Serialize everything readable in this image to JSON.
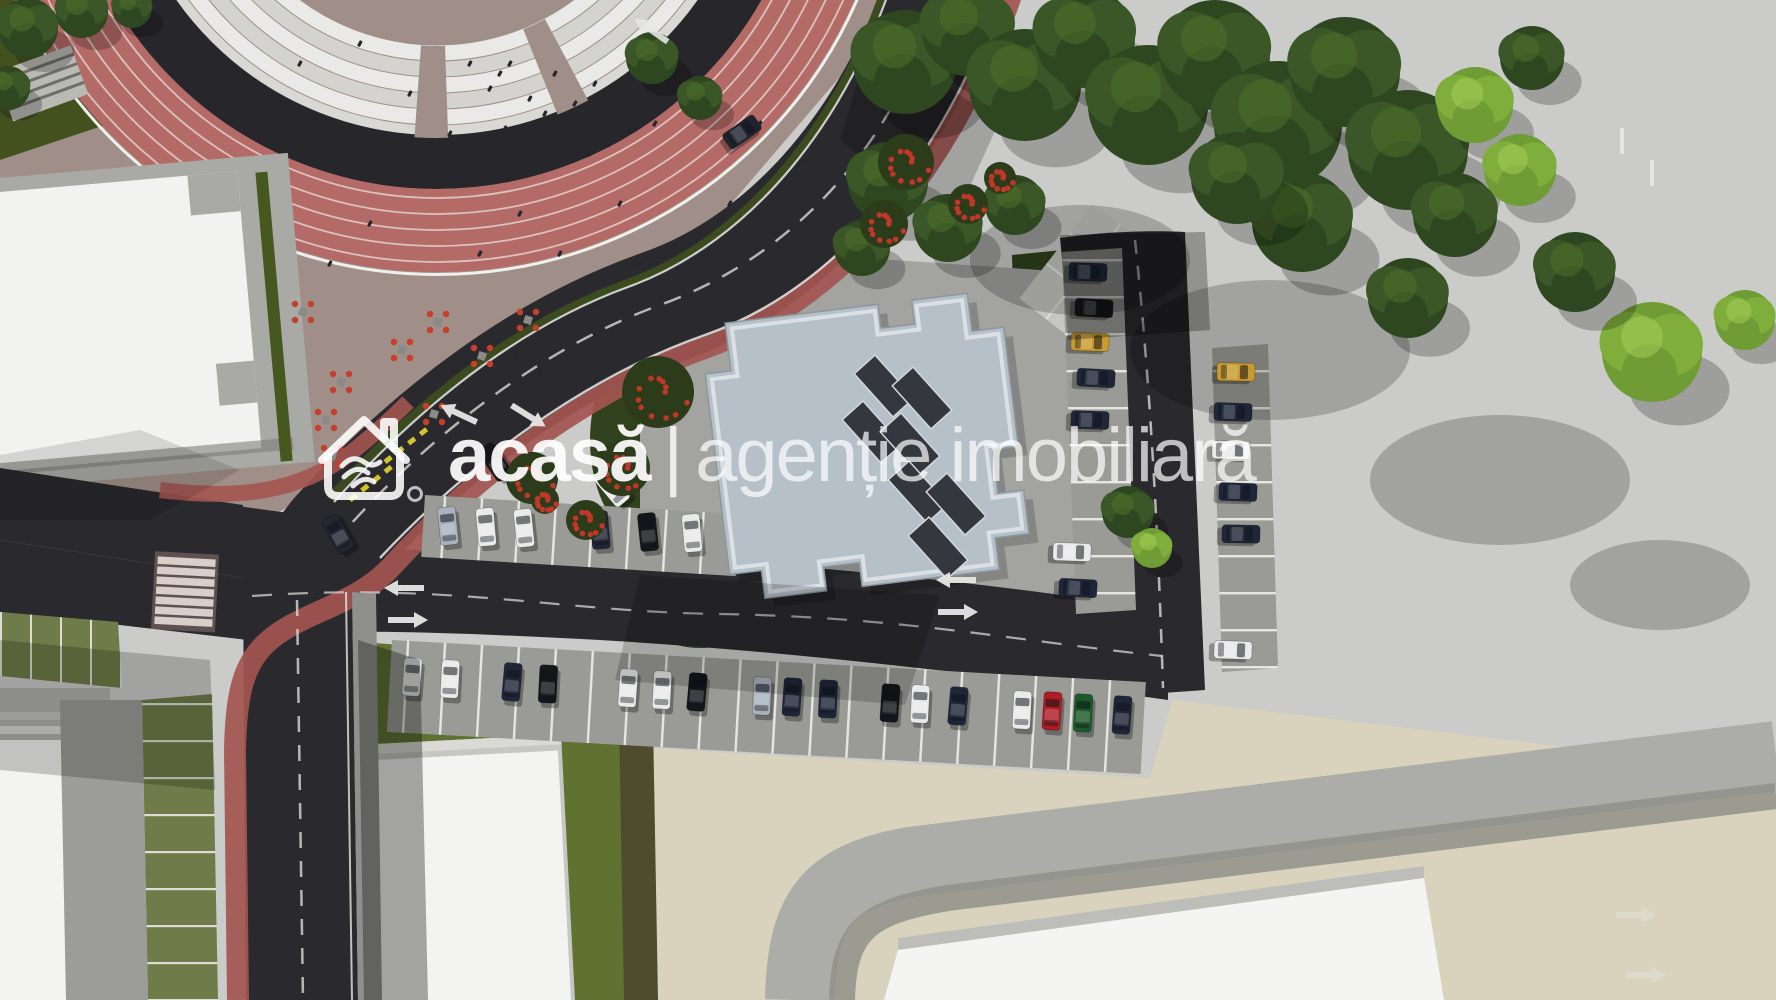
{
  "watermark": {
    "brand": "acasă",
    "separator": "|",
    "tagline": "agenție imobiliară",
    "logo_icon": "house-handshake-icon",
    "color": "#ffffff"
  },
  "scene": {
    "description": "Aerial 3D site plan render: stadium running track top-left, curved boulevard with red bike lanes, central flat-roof building with rooftop panels, parking rows with cars, lawns, trees and concrete esplanade",
    "palette": {
      "asphalt": "#2a2a2e",
      "track_red": "#b46b67",
      "bike_lane_red": "#a35551",
      "plaza_tan": "#a08f88",
      "plaza_beige": "#d9d3bd",
      "concrete": "#cbcbca",
      "roof_blue_gray": "#b6c0c9",
      "lawn_dark": "#31401d",
      "lawn_olive": "#5f7231",
      "paver_green": "#6f7c49",
      "building_white": "#f2f2f0",
      "marking_white": "#e6e6e4",
      "giveway_yellow": "#d4c22e"
    },
    "cars": [
      {
        "x": 412,
        "y": 677,
        "a": 4,
        "c": "#e9eaea"
      },
      {
        "x": 450,
        "y": 679,
        "a": 3,
        "c": "#e9eaea"
      },
      {
        "x": 512,
        "y": 682,
        "a": 5,
        "c": "#1f2638"
      },
      {
        "x": 548,
        "y": 684,
        "a": 3,
        "c": "#15161a"
      },
      {
        "x": 628,
        "y": 688,
        "a": 4,
        "c": "#e9eaea"
      },
      {
        "x": 662,
        "y": 690,
        "a": 3,
        "c": "#e9eaea"
      },
      {
        "x": 697,
        "y": 692,
        "a": 5,
        "c": "#15161a"
      },
      {
        "x": 762,
        "y": 696,
        "a": 3,
        "c": "#aab2bd"
      },
      {
        "x": 792,
        "y": 697,
        "a": 4,
        "c": "#1f2638"
      },
      {
        "x": 828,
        "y": 699,
        "a": 3,
        "c": "#1f2638"
      },
      {
        "x": 890,
        "y": 703,
        "a": 4,
        "c": "#15161a"
      },
      {
        "x": 920,
        "y": 704,
        "a": 3,
        "c": "#e9eaea"
      },
      {
        "x": 958,
        "y": 706,
        "a": 5,
        "c": "#1f2638"
      },
      {
        "x": 1022,
        "y": 710,
        "a": 3,
        "c": "#e9eaea"
      },
      {
        "x": 1052,
        "y": 711,
        "a": 4,
        "c": "#b01c26"
      },
      {
        "x": 1083,
        "y": 713,
        "a": 3,
        "c": "#1c5a2a"
      },
      {
        "x": 1122,
        "y": 715,
        "a": 4,
        "c": "#1f2638"
      },
      {
        "x": 448,
        "y": 526,
        "a": -6,
        "c": "#aab2bd"
      },
      {
        "x": 486,
        "y": 527,
        "a": -5,
        "c": "#e9eaea"
      },
      {
        "x": 524,
        "y": 528,
        "a": -6,
        "c": "#e9eaea"
      },
      {
        "x": 600,
        "y": 530,
        "a": -5,
        "c": "#1f2638"
      },
      {
        "x": 648,
        "y": 532,
        "a": -6,
        "c": "#15161a"
      },
      {
        "x": 692,
        "y": 533,
        "a": -5,
        "c": "#e9eaea"
      },
      {
        "x": 1088,
        "y": 272,
        "a": 92,
        "c": "#1f2638"
      },
      {
        "x": 1094,
        "y": 308,
        "a": 93,
        "c": "#15161a"
      },
      {
        "x": 1090,
        "y": 342,
        "a": 92,
        "c": "#c89b2e"
      },
      {
        "x": 1096,
        "y": 378,
        "a": 93,
        "c": "#1f2638"
      },
      {
        "x": 1090,
        "y": 420,
        "a": 92,
        "c": "#1f2638"
      },
      {
        "x": 1072,
        "y": 552,
        "a": 92,
        "c": "#e9eaea"
      },
      {
        "x": 1078,
        "y": 588,
        "a": 93,
        "c": "#1f2638"
      },
      {
        "x": 1236,
        "y": 372,
        "a": 91,
        "c": "#c89b2e"
      },
      {
        "x": 1233,
        "y": 412,
        "a": 92,
        "c": "#1f2638"
      },
      {
        "x": 1231,
        "y": 450,
        "a": 91,
        "c": "#e9eaea"
      },
      {
        "x": 1238,
        "y": 492,
        "a": 92,
        "c": "#1f2638"
      },
      {
        "x": 1241,
        "y": 534,
        "a": 91,
        "c": "#1f2638"
      },
      {
        "x": 1233,
        "y": 650,
        "a": 92,
        "c": "#e9eaea"
      },
      {
        "x": 338,
        "y": 534,
        "a": -30,
        "c": "#232733"
      },
      {
        "x": 612,
        "y": 488,
        "a": -40,
        "c": "#ededee"
      },
      {
        "x": 495,
        "y": 462,
        "a": -35,
        "c": "#15161a"
      },
      {
        "x": 742,
        "y": 132,
        "a": 55,
        "c": "#20242e"
      }
    ],
    "trees": [
      {
        "x": 905,
        "y": 62,
        "r": 52,
        "t": "dark"
      },
      {
        "x": 968,
        "y": 30,
        "r": 46,
        "t": "dark"
      },
      {
        "x": 1025,
        "y": 85,
        "r": 56,
        "t": "dark"
      },
      {
        "x": 1085,
        "y": 38,
        "r": 50,
        "t": "dark"
      },
      {
        "x": 1148,
        "y": 105,
        "r": 60,
        "t": "dark"
      },
      {
        "x": 1215,
        "y": 55,
        "r": 55,
        "t": "dark"
      },
      {
        "x": 1278,
        "y": 125,
        "r": 64,
        "t": "dark"
      },
      {
        "x": 1345,
        "y": 72,
        "r": 55,
        "t": "dark"
      },
      {
        "x": 1408,
        "y": 150,
        "r": 60,
        "t": "dark"
      },
      {
        "x": 1302,
        "y": 222,
        "r": 50,
        "t": "dark"
      },
      {
        "x": 1237,
        "y": 178,
        "r": 46,
        "t": "dark"
      },
      {
        "x": 1475,
        "y": 105,
        "r": 38,
        "t": "light"
      },
      {
        "x": 1532,
        "y": 58,
        "r": 32,
        "t": "dark"
      },
      {
        "x": 1455,
        "y": 215,
        "r": 42,
        "t": "dark"
      },
      {
        "x": 1520,
        "y": 170,
        "r": 36,
        "t": "light"
      },
      {
        "x": 1408,
        "y": 298,
        "r": 40,
        "t": "dark"
      },
      {
        "x": 1652,
        "y": 352,
        "r": 50,
        "t": "light"
      },
      {
        "x": 1575,
        "y": 272,
        "r": 40,
        "t": "dark"
      },
      {
        "x": 1745,
        "y": 320,
        "r": 30,
        "t": "light"
      },
      {
        "x": 888,
        "y": 182,
        "r": 40,
        "t": "dark"
      },
      {
        "x": 948,
        "y": 228,
        "r": 34,
        "t": "dark"
      },
      {
        "x": 1015,
        "y": 205,
        "r": 30,
        "t": "dark"
      },
      {
        "x": 862,
        "y": 248,
        "r": 28,
        "t": "dark"
      },
      {
        "x": 1128,
        "y": 512,
        "r": 26,
        "t": "dark"
      },
      {
        "x": 1152,
        "y": 548,
        "r": 20,
        "t": "light"
      },
      {
        "x": 28,
        "y": 28,
        "r": 30,
        "t": "dark"
      },
      {
        "x": 82,
        "y": 12,
        "r": 26,
        "t": "dark"
      },
      {
        "x": 8,
        "y": 88,
        "r": 22,
        "t": "dark"
      },
      {
        "x": 132,
        "y": 8,
        "r": 20,
        "t": "dark"
      },
      {
        "x": 652,
        "y": 58,
        "r": 26,
        "t": "dark"
      },
      {
        "x": 700,
        "y": 98,
        "r": 22,
        "t": "dark"
      }
    ],
    "tree_shadows": [
      {
        "x": 1270,
        "y": 350,
        "rx": 140,
        "ry": 70
      },
      {
        "x": 1500,
        "y": 480,
        "rx": 130,
        "ry": 65
      },
      {
        "x": 1660,
        "y": 585,
        "rx": 90,
        "ry": 45
      },
      {
        "x": 1080,
        "y": 260,
        "rx": 110,
        "ry": 55
      }
    ],
    "flower_bushes": [
      {
        "x": 658,
        "y": 392,
        "r": 36
      },
      {
        "x": 622,
        "y": 468,
        "r": 28
      },
      {
        "x": 532,
        "y": 478,
        "r": 26
      },
      {
        "x": 906,
        "y": 162,
        "r": 28
      },
      {
        "x": 884,
        "y": 224,
        "r": 24
      },
      {
        "x": 968,
        "y": 204,
        "r": 20
      },
      {
        "x": 1000,
        "y": 178,
        "r": 16
      },
      {
        "x": 586,
        "y": 520,
        "r": 20
      },
      {
        "x": 545,
        "y": 500,
        "r": 14
      }
    ],
    "people": [
      {
        "x": 300,
        "y": 60
      },
      {
        "x": 330,
        "y": 120
      },
      {
        "x": 360,
        "y": 40
      },
      {
        "x": 410,
        "y": 90
      },
      {
        "x": 450,
        "y": 130
      },
      {
        "x": 500,
        "y": 70
      },
      {
        "x": 545,
        "y": 110
      },
      {
        "x": 590,
        "y": 150
      },
      {
        "x": 620,
        "y": 200
      },
      {
        "x": 640,
        "y": 260
      },
      {
        "x": 430,
        "y": 180
      },
      {
        "x": 370,
        "y": 220
      },
      {
        "x": 330,
        "y": 260
      },
      {
        "x": 480,
        "y": 250
      },
      {
        "x": 520,
        "y": 210
      },
      {
        "x": 560,
        "y": 250
      },
      {
        "x": 600,
        "y": 300
      },
      {
        "x": 760,
        "y": 120
      },
      {
        "x": 800,
        "y": 160
      },
      {
        "x": 730,
        "y": 200
      },
      {
        "x": 470,
        "y": 60
      },
      {
        "x": 490,
        "y": 85
      },
      {
        "x": 510,
        "y": 60
      },
      {
        "x": 530,
        "y": 95
      },
      {
        "x": 555,
        "y": 70
      },
      {
        "x": 575,
        "y": 100
      },
      {
        "x": 595,
        "y": 80
      },
      {
        "x": 615,
        "y": 110
      },
      {
        "x": 505,
        "y": 125
      },
      {
        "x": 560,
        "y": 135
      },
      {
        "x": 610,
        "y": 140
      },
      {
        "x": 655,
        "y": 120
      },
      {
        "x": 515,
        "y": 352
      },
      {
        "x": 540,
        "y": 368
      }
    ],
    "chair_clusters": [
      {
        "x": 303,
        "y": 312
      },
      {
        "x": 341,
        "y": 382
      },
      {
        "x": 326,
        "y": 420
      },
      {
        "x": 332,
        "y": 456
      },
      {
        "x": 438,
        "y": 322
      },
      {
        "x": 482,
        "y": 356
      },
      {
        "x": 528,
        "y": 320
      },
      {
        "x": 434,
        "y": 414
      },
      {
        "x": 402,
        "y": 350
      }
    ],
    "roof_panels": [
      {
        "x": 884,
        "y": 386
      },
      {
        "x": 922,
        "y": 398
      },
      {
        "x": 872,
        "y": 432
      },
      {
        "x": 910,
        "y": 444
      },
      {
        "x": 918,
        "y": 492
      },
      {
        "x": 956,
        "y": 504
      },
      {
        "x": 938,
        "y": 548
      }
    ],
    "road_arrows": [
      {
        "x": 400,
        "y": 588,
        "a": 180,
        "o": 0.95
      },
      {
        "x": 952,
        "y": 580,
        "a": 180,
        "o": 0.95
      },
      {
        "x": 412,
        "y": 620,
        "a": 0,
        "o": 0.95
      },
      {
        "x": 962,
        "y": 612,
        "a": 0,
        "o": 0.95
      },
      {
        "x": 455,
        "y": 412,
        "a": 205,
        "o": 0.95
      },
      {
        "x": 532,
        "y": 418,
        "a": 32,
        "o": 0.95
      },
      {
        "x": 648,
        "y": 28,
        "a": 215,
        "o": 0.9
      },
      {
        "x": 1640,
        "y": 915,
        "a": 0,
        "o": 0.4
      },
      {
        "x": 1650,
        "y": 975,
        "a": 0,
        "o": 0.4
      }
    ],
    "concrete_ticks": [
      {
        "x": 1620,
        "y": 128
      },
      {
        "x": 1650,
        "y": 160
      }
    ]
  }
}
